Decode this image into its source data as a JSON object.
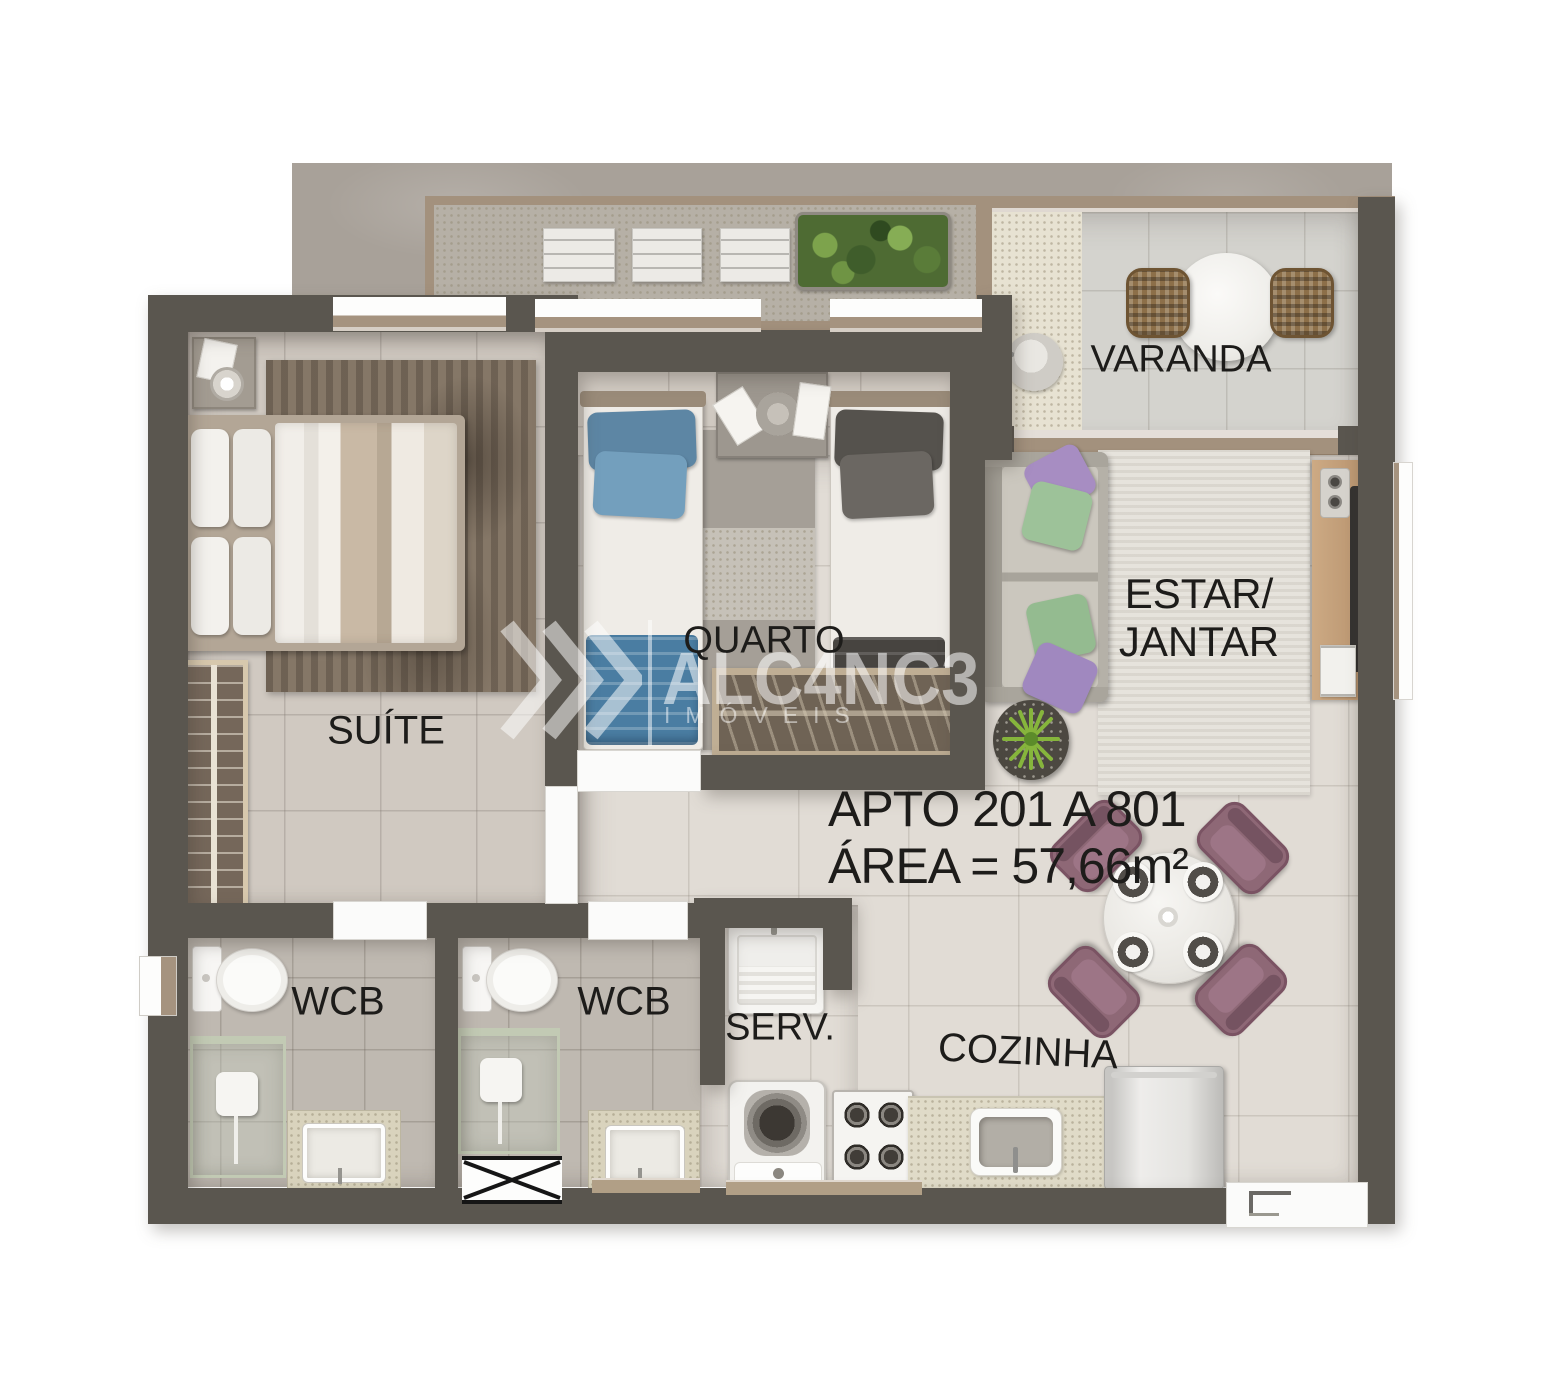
{
  "labels": {
    "varanda": "VARANDA",
    "suite": "SUÍTE",
    "quarto": "QUARTO",
    "estar_line1": "ESTAR/",
    "estar_line2": "JANTAR",
    "wcb1": "WCB",
    "wcb2": "WCB",
    "serv": "SERV.",
    "cozinha": "COZINHA"
  },
  "apartment": {
    "unit_range": "APTO 201 A 801",
    "area": "ÁREA = 57,66m²"
  },
  "watermark": {
    "brand": "ALC4NC3",
    "subtitle": "IMÓVEIS",
    "chevrons_icon": "triple-chevron-right"
  },
  "colors": {
    "wall": "#5a564f",
    "floor_tile": "#d0c9c1",
    "floor_light": "#e1dcd5",
    "bath_tile": "#bfb9b1",
    "concrete": "#a8a199",
    "wood_frame": "#a5937f",
    "bed_blue_pillow": "#5d86a4",
    "bed_blue_blanket": "#4a7da2",
    "bed_dark": "#55524d",
    "pillow_purple": "#a78dc2",
    "pillow_green": "#9dc299",
    "chair_mauve": "#8e6876",
    "tv_wood": "#c3a07a",
    "label_text": "#1d1c1a",
    "watermark_white": "rgba(255,255,255,0.55)"
  }
}
